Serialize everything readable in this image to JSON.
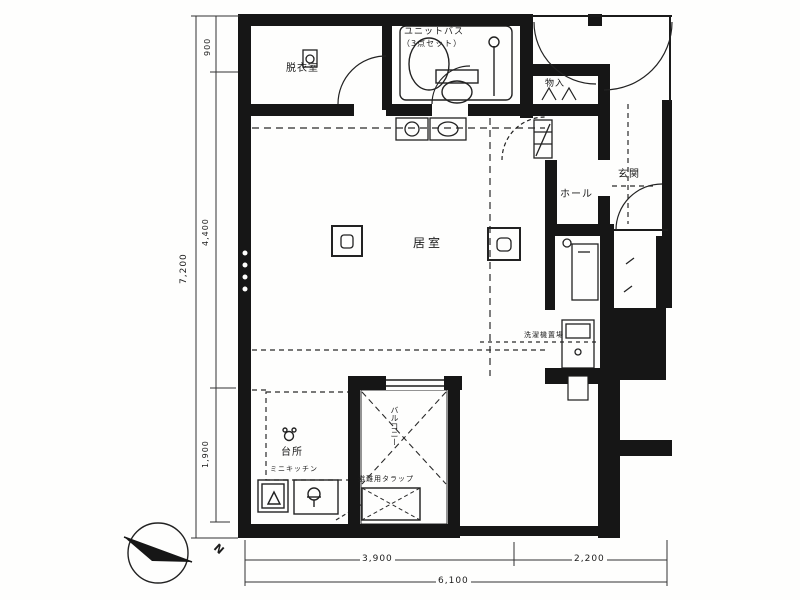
{
  "plan": {
    "rooms": {
      "dressing": "脱衣室",
      "unit_bath_line1": "ユニットバス",
      "unit_bath_line2": "（3点セット）",
      "storage": "物入",
      "entrance": "玄関",
      "hall": "ホール",
      "living": "居室",
      "kitchen": "台所",
      "mini_kitchen": "ミニキッチン",
      "washer": "洗濯機置場",
      "balcony": "バルコニー",
      "escape_hatch": "避難用タラップ"
    },
    "dimensions": {
      "left_total": "7,200",
      "left_top": "900",
      "left_middle": "4,400",
      "left_bottom": "1,900",
      "bottom_left": "3,900",
      "bottom_right": "2,200",
      "bottom_total": "6,100"
    },
    "compass": {
      "north": "N"
    },
    "colors": {
      "ink": "#1b1b1b",
      "paper": "#fefefd"
    }
  }
}
